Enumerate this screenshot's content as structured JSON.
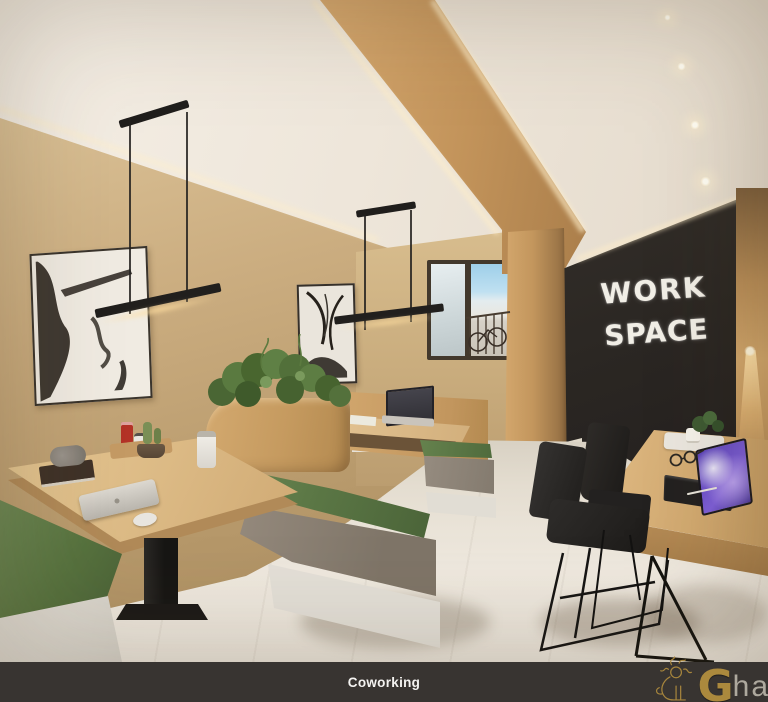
{
  "scene": {
    "chalkboard": {
      "line1": "WORK",
      "line2": "SPACE"
    },
    "caption": {
      "label": "Coworking"
    },
    "brand": {
      "initial": "G",
      "rest": "har"
    }
  },
  "palette": {
    "wall_beige": "#c7a97b",
    "ceiling_cream": "#f1eae0",
    "wood_beam": "#c59a63",
    "chalkboard_dark": "#2d2925",
    "chalk_white": "#f1eee6",
    "cushion_green": "#5a7545",
    "bench_taupe": "#8d8378",
    "bench_plinth_white": "#e3dfd8",
    "table_wood": "#d9ba8a",
    "floor_tile": "#e9e3d8",
    "caption_bg": "#383431",
    "caption_text": "#f4f3f1",
    "logo_gold": "#b5913f",
    "tablet_screen_purple": "#7a5cd6",
    "chair_black": "#242220",
    "pendant_black": "#211f1d",
    "window_sky": "#9ecfe9"
  }
}
